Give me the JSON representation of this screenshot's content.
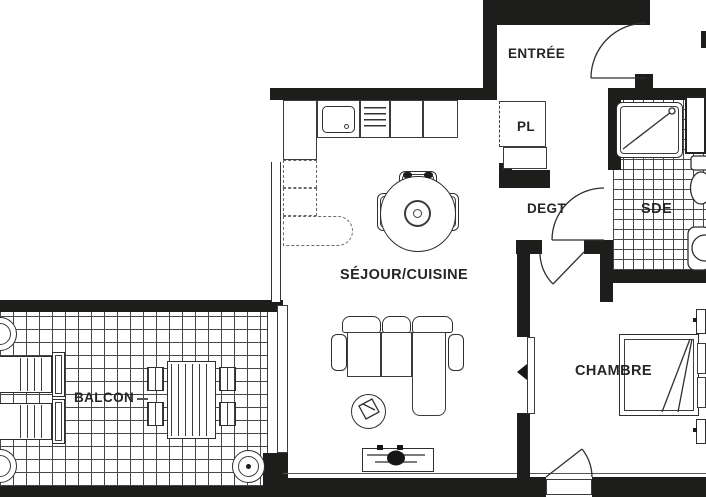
{
  "plan": {
    "colors": {
      "wall": "#1d1d1b",
      "background": "#ffffff",
      "line": "#3c3c3c"
    },
    "rooms": {
      "entree": "ENTRÉE",
      "placard": "PL",
      "degagement": "DEGT",
      "salle_eau": "SDE",
      "sejour_cuisine": "SÉJOUR/CUISINE",
      "chambre": "CHAMBRE",
      "balcon": "BALCON"
    }
  }
}
